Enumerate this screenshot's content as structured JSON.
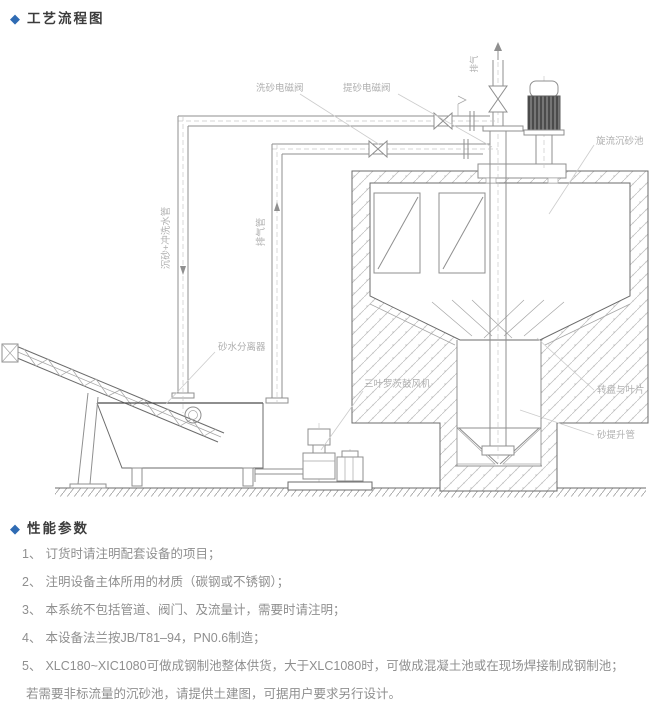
{
  "page": {
    "accent_color": "#2f6bb3",
    "diamond_icon": "◆"
  },
  "sections": {
    "process_flow_title": "工艺流程图",
    "performance_title": "性能参数"
  },
  "diagram": {
    "labels": {
      "wash_valve": "洗砂电磁阀",
      "lift_valve": "提砂电磁阀",
      "vent": "排气",
      "cyclone_tank": "旋流沉砂池",
      "grit_wash_pipe": "沉砂+冲洗水管",
      "exhaust_pipe": "排气管",
      "sand_water_separator": "砂水分离器",
      "roots_blower": "三叶罗茨鼓风机",
      "disc_blades": "转盘与叶片",
      "sand_lift_pipe": "砂提升管"
    }
  },
  "notes": {
    "items": [
      {
        "num": "1、",
        "text": "订货时请注明配套设备的项目；"
      },
      {
        "num": "2、",
        "text": "注明设备主体所用的材质（碳钢或不锈钢）；"
      },
      {
        "num": "3、",
        "text": "本系统不包括管道、阀门、及流量计，需要时请注明；"
      },
      {
        "num": "4、",
        "text": "本设备法兰按JB/T81–94，PN0.6制造；"
      },
      {
        "num": "5、",
        "text": "XLC180~XIC1080可做成钢制池整体供货，大于XLC1080时，可做成混凝土池或在现场焊接制成钢制池；"
      },
      {
        "num": "",
        "text": "若需要非标流量的沉砂池，请提供土建图，可据用户要求另行设计。"
      }
    ]
  }
}
